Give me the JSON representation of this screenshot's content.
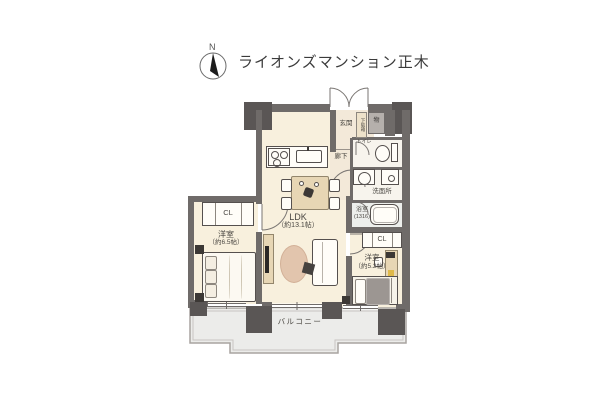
{
  "header": {
    "title": "ライオンズマンション正木",
    "compass_north": "N"
  },
  "rooms": {
    "ldk": {
      "name": "LDK",
      "size": "（約13.1帖）"
    },
    "bedroom_left": {
      "name": "洋室",
      "size": "（約6.5帖）"
    },
    "bedroom_right": {
      "name": "洋室",
      "size": "（約5.2帖）"
    },
    "entrance": {
      "name": "玄関"
    },
    "hallway": {
      "name": "廊下"
    },
    "toilet": {
      "name": "トイレ"
    },
    "washroom": {
      "name": "洗面所"
    },
    "bathroom": {
      "name": "浴室",
      "size": "(1316)"
    },
    "closet_left": {
      "name": "CL"
    },
    "closet_right": {
      "name": "CL"
    },
    "shoe_cabinet": {
      "name": "下駄箱"
    },
    "storage": {
      "name": "物"
    },
    "balcony": {
      "name": "バルコニー"
    }
  },
  "colors": {
    "wall": "#6f6b69",
    "pillar": "#5a5655",
    "floor": "#f8f0dd",
    "entrance_floor": "#f3e9d9",
    "wet_area": "#f7f4ed",
    "balcony": "#ececea",
    "wood_furniture": "#e7d6b4",
    "rug": "#e2c5ad",
    "blanket": "#9c9692",
    "text": "#4a4742"
  }
}
